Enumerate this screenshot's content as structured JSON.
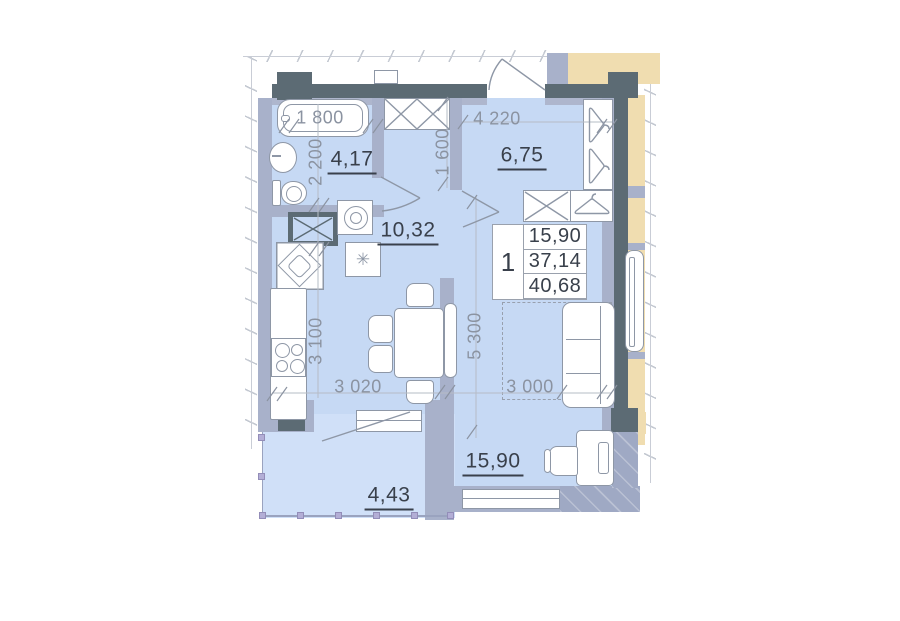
{
  "dims": {
    "d1800": "1 800",
    "d2200": "2 200",
    "d4220": "4 220",
    "d1600": "1 600",
    "d3100": "3 100",
    "d3020": "3 020",
    "d5300": "5 300",
    "d3000": "3 000"
  },
  "areas": {
    "bathroom": "4,17",
    "bedroom": "6,75",
    "hall": "10,32",
    "living": "15,90",
    "balcony": "4,43"
  },
  "info_table": {
    "rooms_count": "1",
    "living_area": "15,90",
    "apartment_area": "37,14",
    "total_area": "40,68"
  },
  "symbols": {
    "asterisk": "✳"
  },
  "colors": {
    "room_fill": "#c6d9f4",
    "balcony_fill": "#d0e0f8",
    "wall_light": "#a8b1ca",
    "wall_dark": "#5c6b74",
    "adjacent_fill": "#f0ddb0"
  }
}
